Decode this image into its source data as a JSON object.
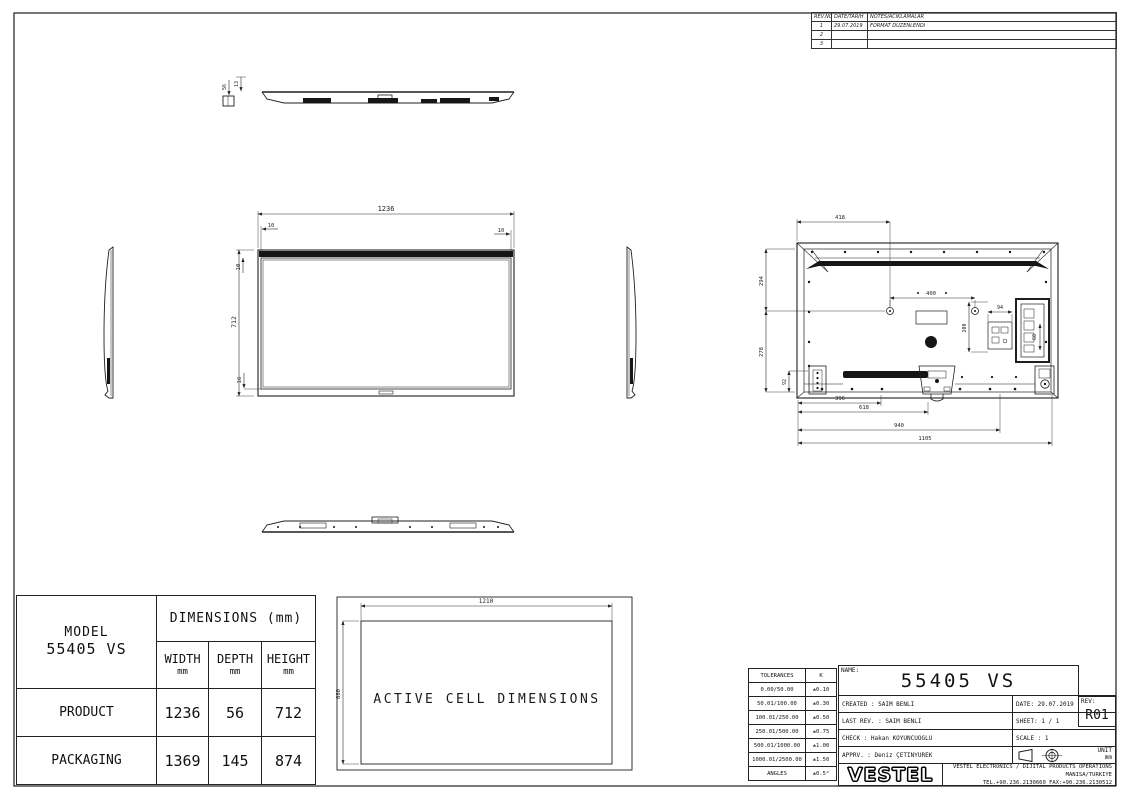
{
  "revision_table": {
    "headers": {
      "rev_no": "REV.NO",
      "date": "DATE/TARIH",
      "notes": "NOTES/ACIKLAMALAR"
    },
    "rows": [
      {
        "no": "1",
        "date": "29.07.2019",
        "note": "FORMAT DUZENLENDI"
      },
      {
        "no": "2",
        "date": "",
        "note": ""
      },
      {
        "no": "3",
        "date": "",
        "note": ""
      }
    ]
  },
  "views": {
    "top_view": {
      "d13": "13",
      "d56": "56"
    },
    "front_view": {
      "d1236": "1236",
      "d712": "712",
      "d10_top": "10",
      "d10_left": "10",
      "d10_right": "10",
      "d16": "16"
    },
    "rear_view": {
      "d418": "418",
      "d294": "294",
      "d400": "400",
      "d94": "94",
      "d200": "200",
      "d60": "60",
      "d278": "278",
      "d92": "92",
      "d396": "396",
      "d618": "618",
      "d940": "940",
      "d1105": "1105"
    },
    "active_cell": {
      "label": "ACTIVE CELL DIMENSIONS",
      "d1210": "1210",
      "d680": "680"
    }
  },
  "dimensions_table": {
    "model_label": "MODEL",
    "model_value": "55405 VS",
    "header": "DIMENSIONS (mm)",
    "columns": [
      {
        "label": "WIDTH",
        "unit": "mm"
      },
      {
        "label": "DEPTH",
        "unit": "mm"
      },
      {
        "label": "HEIGHT",
        "unit": "mm"
      }
    ],
    "rows": [
      {
        "label": "PRODUCT",
        "width": "1236",
        "depth": "56",
        "height": "712"
      },
      {
        "label": "PACKAGING",
        "width": "1369",
        "depth": "145",
        "height": "874"
      }
    ]
  },
  "tolerances": {
    "title": "TOLERANCES",
    "k_label": "K",
    "rows": [
      [
        "0.00/50.00",
        "±0.10"
      ],
      [
        "50.01/100.00",
        "±0.30"
      ],
      [
        "100.01/250.00",
        "±0.50"
      ],
      [
        "250.01/500.00",
        "±0.75"
      ],
      [
        "500.01/1000.00",
        "±1.00"
      ],
      [
        "1000.01/2500.00",
        "±1.50"
      ],
      [
        "ANGLES",
        "±0.5°"
      ]
    ]
  },
  "title_block": {
    "name_label": "NAME:",
    "name_value": "55405 VS",
    "rev_label": "REV:",
    "rev_value": "R01",
    "created": "CREATED : SAIM BENLI",
    "date": "DATE: 29.07.2019",
    "last_rev": "LAST REV. : SAIM BENLI",
    "sheet": "SHEET: 1 / 1",
    "check": "CHECK : Hakan KOYUNCUOGLU",
    "scale": "SCALE : 1",
    "apprv": "APPRV. : Deniz ÇETINYUREK",
    "unit_label": "UNIT",
    "unit_value": "mm",
    "logo": "VESTEL",
    "company_line1": "VESTEL ELECTRONICS / DIJITAL PRODUCTS OPERATIONS MANISA/TURKIYE",
    "company_line2": "TEL.+90.236.2130660 FAX:+90.236.2130512"
  }
}
